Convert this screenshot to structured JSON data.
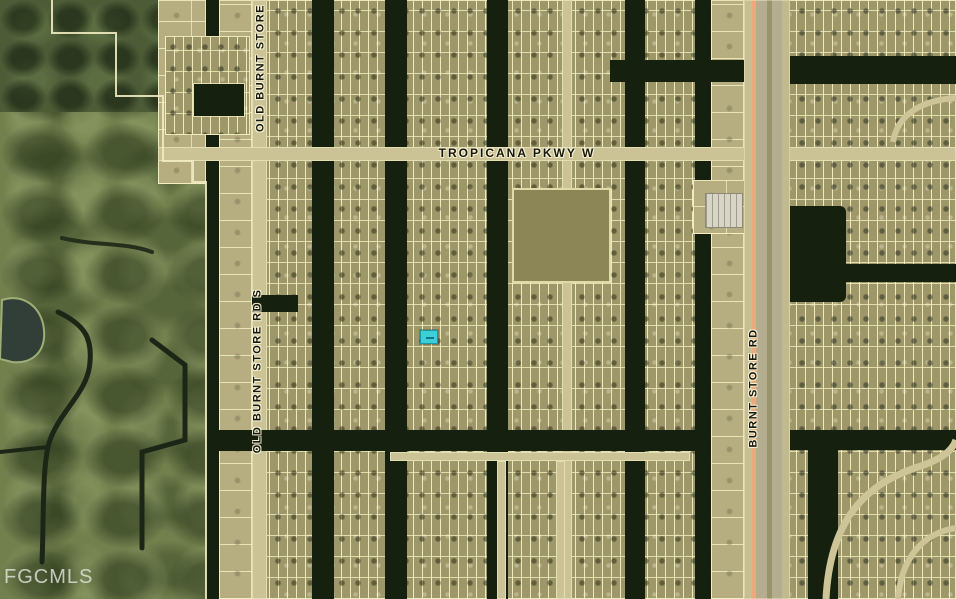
{
  "map": {
    "type": "aerial-parcel-map",
    "watermark": "FGCMLS",
    "street_labels": {
      "tropicana": "TROPICANA PKWY W",
      "old_burnt_store_top": "OLD BURNT STORE",
      "old_burnt_store_south": "OLD BURNT STORE RD S",
      "burnt_store": "BURNT STORE RD"
    },
    "marker": {
      "description": "highlighted subject property lot",
      "color": "#3ECFD6"
    },
    "colors": {
      "canal_water": "#16200F",
      "residential_ground": "#9E9769",
      "lot_line": "#F3EEBE",
      "natural_vegetation": "#72804E",
      "road": "#CBC295",
      "highway_edge_stripe": "#ECA97C",
      "vacant_field": "#8C8657",
      "watermark_text": "#E4E7E0"
    }
  }
}
